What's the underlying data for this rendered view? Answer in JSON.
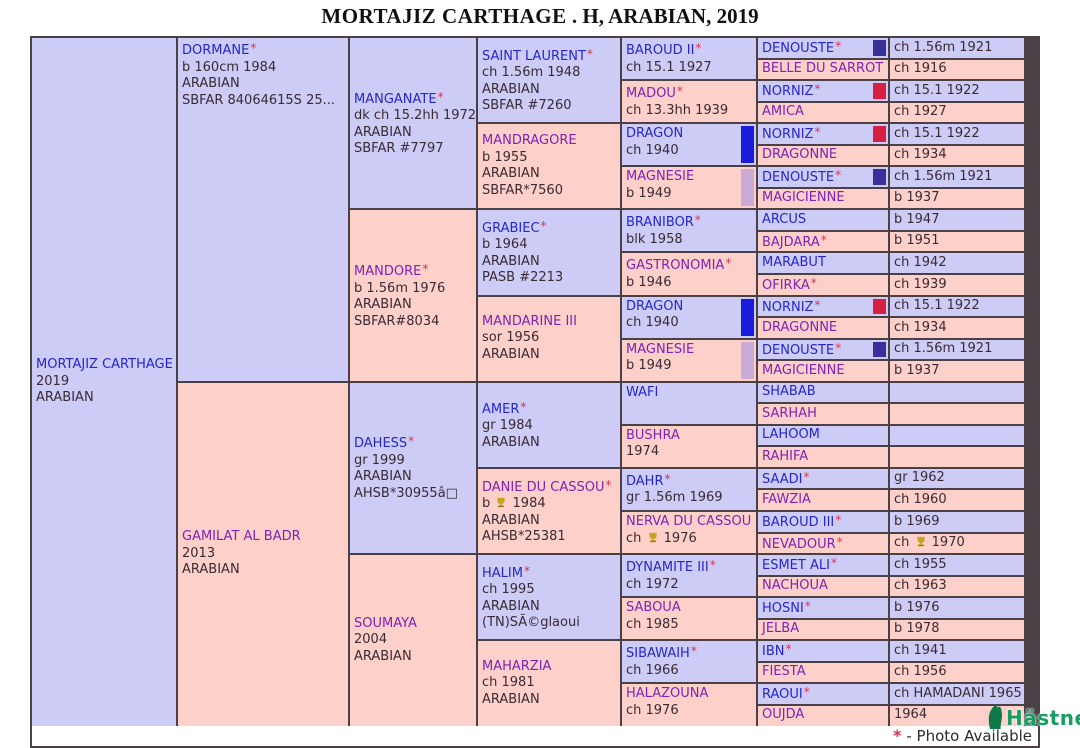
{
  "title": {
    "name": "MORTAJIZ CARTHAGE",
    "rest": " . H, ARABIAN, 2019"
  },
  "footer": {
    "asterisk": "*",
    "note": "- Photo Available"
  },
  "logo": {
    "text": "Hästnet"
  },
  "colors": {
    "male_bg": "#ccccf7",
    "female_bg": "#fdd0ca",
    "male_name": "#2626cc",
    "female_name": "#7d22b5",
    "detail_text": "#3a2a33",
    "asterisk": "#e03050",
    "border": "#4a4046",
    "award_gold": "#c9a227",
    "logo_green": "#189e62",
    "flags": {
      "navy": "#39309c",
      "red": "#d62043",
      "blue": "#1b1bdb",
      "lavender": "#c9abd6"
    }
  },
  "pedigree": {
    "cells": [
      {
        "col": 1,
        "row": 1,
        "span": 32,
        "sex": "m",
        "name": "MORTAJIZ CARTHAGE",
        "ast": false,
        "lines": [
          "2019",
          "ARABIAN"
        ]
      },
      {
        "col": 2,
        "row": 1,
        "span": 16,
        "sex": "m",
        "va": "top",
        "name": "DORMANE",
        "ast": true,
        "lines": [
          "b 160cm 1984",
          "ARABIAN",
          "SBFAR 84064615S 25..."
        ]
      },
      {
        "col": 2,
        "row": 17,
        "span": 16,
        "sex": "f",
        "name": "GAMILAT AL BADR",
        "ast": false,
        "lines": [
          "2013",
          "ARABIAN"
        ]
      },
      {
        "col": 3,
        "row": 1,
        "span": 8,
        "sex": "m",
        "name": "MANGANATE",
        "ast": true,
        "lines": [
          "dk ch 15.2hh 1972",
          "ARABIAN",
          "SBFAR #7797"
        ]
      },
      {
        "col": 3,
        "row": 9,
        "span": 8,
        "sex": "f",
        "name": "MANDORE",
        "ast": true,
        "lines": [
          "b 1.56m 1976",
          "ARABIAN",
          "SBFAR#8034"
        ]
      },
      {
        "col": 3,
        "row": 17,
        "span": 8,
        "sex": "m",
        "name": "DAHESS",
        "ast": true,
        "lines": [
          "gr 1999",
          "ARABIAN",
          "AHSB*30955â□"
        ]
      },
      {
        "col": 3,
        "row": 25,
        "span": 8,
        "sex": "f",
        "name": "SOUMAYA",
        "ast": false,
        "lines": [
          "2004",
          "ARABIAN"
        ]
      },
      {
        "col": 4,
        "row": 1,
        "span": 4,
        "sex": "m",
        "name": "SAINT LAURENT",
        "ast": true,
        "lines": [
          "ch 1.56m 1948",
          "ARABIAN",
          "SBFAR #7260"
        ]
      },
      {
        "col": 4,
        "row": 5,
        "span": 4,
        "sex": "f",
        "name": "MANDRAGORE",
        "ast": false,
        "lines": [
          "b 1955",
          "ARABIAN",
          "SBFAR*7560"
        ]
      },
      {
        "col": 4,
        "row": 9,
        "span": 4,
        "sex": "m",
        "name": "GRABIEC",
        "ast": true,
        "lines": [
          "b 1964",
          "ARABIAN",
          "PASB #2213"
        ]
      },
      {
        "col": 4,
        "row": 13,
        "span": 4,
        "sex": "f",
        "name": "MANDARINE III",
        "ast": false,
        "lines": [
          "sor 1956",
          "ARABIAN"
        ]
      },
      {
        "col": 4,
        "row": 17,
        "span": 4,
        "sex": "m",
        "name": "AMER",
        "ast": true,
        "lines": [
          "gr 1984",
          "ARABIAN"
        ]
      },
      {
        "col": 4,
        "row": 21,
        "span": 4,
        "sex": "f",
        "name": "DANIE DU CASSOU",
        "ast": true,
        "lines": [
          "b [award] 1984",
          "ARABIAN",
          "AHSB*25381"
        ]
      },
      {
        "col": 4,
        "row": 25,
        "span": 4,
        "sex": "m",
        "name": "HALIM",
        "ast": true,
        "lines": [
          "ch 1995",
          "ARABIAN",
          "(TN)SÃ©glaoui"
        ]
      },
      {
        "col": 4,
        "row": 29,
        "span": 4,
        "sex": "f",
        "name": "MAHARZIA",
        "ast": false,
        "lines": [
          "ch 1981",
          "ARABIAN"
        ]
      },
      {
        "col": 5,
        "row": 1,
        "span": 2,
        "sex": "m",
        "name": "BAROUD II",
        "ast": true,
        "lines": [
          "ch 15.1 1927"
        ]
      },
      {
        "col": 5,
        "row": 3,
        "span": 2,
        "sex": "f",
        "name": "MADOU",
        "ast": true,
        "lines": [
          "ch 13.3hh 1939"
        ]
      },
      {
        "col": 5,
        "row": 5,
        "span": 2,
        "sex": "m",
        "name": "DRAGON",
        "ast": false,
        "flag": "blue",
        "lines": [
          "ch 1940"
        ]
      },
      {
        "col": 5,
        "row": 7,
        "span": 2,
        "sex": "f",
        "name": "MAGNESIE",
        "ast": false,
        "flag": "lavender",
        "lines": [
          "b 1949"
        ]
      },
      {
        "col": 5,
        "row": 9,
        "span": 2,
        "sex": "m",
        "name": "BRANIBOR",
        "ast": true,
        "lines": [
          "blk 1958"
        ]
      },
      {
        "col": 5,
        "row": 11,
        "span": 2,
        "sex": "f",
        "name": "GASTRONOMIA",
        "ast": true,
        "lines": [
          "b 1946"
        ]
      },
      {
        "col": 5,
        "row": 13,
        "span": 2,
        "sex": "m",
        "name": "DRAGON",
        "ast": false,
        "flag": "blue",
        "lines": [
          "ch 1940"
        ]
      },
      {
        "col": 5,
        "row": 15,
        "span": 2,
        "sex": "f",
        "name": "MAGNESIE",
        "ast": false,
        "flag": "lavender",
        "lines": [
          "b 1949"
        ]
      },
      {
        "col": 5,
        "row": 17,
        "span": 2,
        "sex": "m",
        "name": "WAFI",
        "ast": false,
        "lines": []
      },
      {
        "col": 5,
        "row": 19,
        "span": 2,
        "sex": "f",
        "name": "BUSHRA",
        "ast": false,
        "lines": [
          "1974"
        ]
      },
      {
        "col": 5,
        "row": 21,
        "span": 2,
        "sex": "m",
        "name": "DAHR",
        "ast": true,
        "lines": [
          "gr 1.56m 1969"
        ]
      },
      {
        "col": 5,
        "row": 23,
        "span": 2,
        "sex": "f",
        "name": "NERVA DU CASSOU",
        "ast": false,
        "lines": [
          "ch [award] 1976"
        ]
      },
      {
        "col": 5,
        "row": 25,
        "span": 2,
        "sex": "m",
        "name": "DYNAMITE III",
        "ast": true,
        "lines": [
          "ch 1972"
        ]
      },
      {
        "col": 5,
        "row": 27,
        "span": 2,
        "sex": "f",
        "name": "SABOUA",
        "ast": false,
        "lines": [
          "ch 1985"
        ]
      },
      {
        "col": 5,
        "row": 29,
        "span": 2,
        "sex": "m",
        "name": "SIBAWAIH",
        "ast": true,
        "lines": [
          "ch 1966"
        ]
      },
      {
        "col": 5,
        "row": 31,
        "span": 2,
        "sex": "f",
        "name": "HALAZOUNA",
        "ast": false,
        "lines": [
          "ch 1976"
        ]
      },
      {
        "col": 6,
        "row": 1,
        "span": 1,
        "sex": "m",
        "name": "DENOUSTE",
        "ast": true,
        "flag": "navy",
        "lines": []
      },
      {
        "col": 6,
        "row": 2,
        "span": 1,
        "sex": "f",
        "name": "BELLE DU SARROT",
        "ast": false,
        "lines": []
      },
      {
        "col": 6,
        "row": 3,
        "span": 1,
        "sex": "m",
        "name": "NORNIZ",
        "ast": true,
        "flag": "red",
        "lines": []
      },
      {
        "col": 6,
        "row": 4,
        "span": 1,
        "sex": "f",
        "name": "AMICA",
        "ast": false,
        "lines": []
      },
      {
        "col": 6,
        "row": 5,
        "span": 1,
        "sex": "m",
        "name": "NORNIZ",
        "ast": true,
        "flag": "red",
        "lines": []
      },
      {
        "col": 6,
        "row": 6,
        "span": 1,
        "sex": "f",
        "name": "DRAGONNE",
        "ast": false,
        "lines": []
      },
      {
        "col": 6,
        "row": 7,
        "span": 1,
        "sex": "m",
        "name": "DENOUSTE",
        "ast": true,
        "flag": "navy",
        "lines": []
      },
      {
        "col": 6,
        "row": 8,
        "span": 1,
        "sex": "f",
        "name": "MAGICIENNE",
        "ast": false,
        "lines": []
      },
      {
        "col": 6,
        "row": 9,
        "span": 1,
        "sex": "m",
        "name": "ARCUS",
        "ast": false,
        "lines": []
      },
      {
        "col": 6,
        "row": 10,
        "span": 1,
        "sex": "f",
        "name": "BAJDARA",
        "ast": true,
        "lines": []
      },
      {
        "col": 6,
        "row": 11,
        "span": 1,
        "sex": "m",
        "name": "MARABUT",
        "ast": false,
        "lines": []
      },
      {
        "col": 6,
        "row": 12,
        "span": 1,
        "sex": "f",
        "name": "OFIRKA",
        "ast": true,
        "lines": []
      },
      {
        "col": 6,
        "row": 13,
        "span": 1,
        "sex": "m",
        "name": "NORNIZ",
        "ast": true,
        "flag": "red",
        "lines": []
      },
      {
        "col": 6,
        "row": 14,
        "span": 1,
        "sex": "f",
        "name": "DRAGONNE",
        "ast": false,
        "lines": []
      },
      {
        "col": 6,
        "row": 15,
        "span": 1,
        "sex": "m",
        "name": "DENOUSTE",
        "ast": true,
        "flag": "navy",
        "lines": []
      },
      {
        "col": 6,
        "row": 16,
        "span": 1,
        "sex": "f",
        "name": "MAGICIENNE",
        "ast": false,
        "lines": []
      },
      {
        "col": 6,
        "row": 17,
        "span": 1,
        "sex": "m",
        "name": "SHABAB",
        "ast": false,
        "lines": []
      },
      {
        "col": 6,
        "row": 18,
        "span": 1,
        "sex": "f",
        "name": "SARHAH",
        "ast": false,
        "lines": []
      },
      {
        "col": 6,
        "row": 19,
        "span": 1,
        "sex": "m",
        "name": "LAHOOM",
        "ast": false,
        "lines": []
      },
      {
        "col": 6,
        "row": 20,
        "span": 1,
        "sex": "f",
        "name": "RAHIFA",
        "ast": false,
        "lines": []
      },
      {
        "col": 6,
        "row": 21,
        "span": 1,
        "sex": "m",
        "name": "SAADI",
        "ast": true,
        "lines": []
      },
      {
        "col": 6,
        "row": 22,
        "span": 1,
        "sex": "f",
        "name": "FAWZIA",
        "ast": false,
        "lines": []
      },
      {
        "col": 6,
        "row": 23,
        "span": 1,
        "sex": "m",
        "name": "BAROUD III",
        "ast": true,
        "lines": []
      },
      {
        "col": 6,
        "row": 24,
        "span": 1,
        "sex": "f",
        "name": "NEVADOUR",
        "ast": true,
        "lines": []
      },
      {
        "col": 6,
        "row": 25,
        "span": 1,
        "sex": "m",
        "name": "ESMET ALI",
        "ast": true,
        "lines": []
      },
      {
        "col": 6,
        "row": 26,
        "span": 1,
        "sex": "f",
        "name": "NACHOUA",
        "ast": false,
        "lines": []
      },
      {
        "col": 6,
        "row": 27,
        "span": 1,
        "sex": "m",
        "name": "HOSNI",
        "ast": true,
        "lines": []
      },
      {
        "col": 6,
        "row": 28,
        "span": 1,
        "sex": "f",
        "name": "JELBA",
        "ast": false,
        "lines": []
      },
      {
        "col": 6,
        "row": 29,
        "span": 1,
        "sex": "m",
        "name": "IBN",
        "ast": true,
        "lines": []
      },
      {
        "col": 6,
        "row": 30,
        "span": 1,
        "sex": "f",
        "name": "FIESTA",
        "ast": false,
        "lines": []
      },
      {
        "col": 6,
        "row": 31,
        "span": 1,
        "sex": "m",
        "name": "RAOUI",
        "ast": true,
        "lines": []
      },
      {
        "col": 6,
        "row": 32,
        "span": 1,
        "sex": "f",
        "name": "OUJDA",
        "ast": false,
        "lines": []
      },
      {
        "col": 7,
        "row": 1,
        "span": 1,
        "sex": "m",
        "lines": [
          "ch 1.56m 1921"
        ]
      },
      {
        "col": 7,
        "row": 2,
        "span": 1,
        "sex": "f",
        "lines": [
          "ch 1916"
        ]
      },
      {
        "col": 7,
        "row": 3,
        "span": 1,
        "sex": "m",
        "lines": [
          "ch 15.1 1922"
        ]
      },
      {
        "col": 7,
        "row": 4,
        "span": 1,
        "sex": "f",
        "lines": [
          "ch 1927"
        ]
      },
      {
        "col": 7,
        "row": 5,
        "span": 1,
        "sex": "m",
        "lines": [
          "ch 15.1 1922"
        ]
      },
      {
        "col": 7,
        "row": 6,
        "span": 1,
        "sex": "f",
        "lines": [
          "ch 1934"
        ]
      },
      {
        "col": 7,
        "row": 7,
        "span": 1,
        "sex": "m",
        "lines": [
          "ch 1.56m 1921"
        ]
      },
      {
        "col": 7,
        "row": 8,
        "span": 1,
        "sex": "f",
        "lines": [
          "b 1937"
        ]
      },
      {
        "col": 7,
        "row": 9,
        "span": 1,
        "sex": "m",
        "lines": [
          "b 1947"
        ]
      },
      {
        "col": 7,
        "row": 10,
        "span": 1,
        "sex": "f",
        "lines": [
          "b 1951"
        ]
      },
      {
        "col": 7,
        "row": 11,
        "span": 1,
        "sex": "m",
        "lines": [
          "ch 1942"
        ]
      },
      {
        "col": 7,
        "row": 12,
        "span": 1,
        "sex": "f",
        "lines": [
          "ch 1939"
        ]
      },
      {
        "col": 7,
        "row": 13,
        "span": 1,
        "sex": "m",
        "lines": [
          "ch 15.1 1922"
        ]
      },
      {
        "col": 7,
        "row": 14,
        "span": 1,
        "sex": "f",
        "lines": [
          "ch 1934"
        ]
      },
      {
        "col": 7,
        "row": 15,
        "span": 1,
        "sex": "m",
        "lines": [
          "ch 1.56m 1921"
        ]
      },
      {
        "col": 7,
        "row": 16,
        "span": 1,
        "sex": "f",
        "lines": [
          "b 1937"
        ]
      },
      {
        "col": 7,
        "row": 17,
        "span": 1,
        "sex": "m",
        "lines": []
      },
      {
        "col": 7,
        "row": 18,
        "span": 1,
        "sex": "f",
        "lines": []
      },
      {
        "col": 7,
        "row": 19,
        "span": 1,
        "sex": "m",
        "lines": []
      },
      {
        "col": 7,
        "row": 20,
        "span": 1,
        "sex": "f",
        "lines": []
      },
      {
        "col": 7,
        "row": 21,
        "span": 1,
        "sex": "m",
        "lines": [
          "gr 1962"
        ]
      },
      {
        "col": 7,
        "row": 22,
        "span": 1,
        "sex": "f",
        "lines": [
          "ch 1960"
        ]
      },
      {
        "col": 7,
        "row": 23,
        "span": 1,
        "sex": "m",
        "lines": [
          "b 1969"
        ]
      },
      {
        "col": 7,
        "row": 24,
        "span": 1,
        "sex": "f",
        "lines": [
          "ch [award] 1970"
        ]
      },
      {
        "col": 7,
        "row": 25,
        "span": 1,
        "sex": "m",
        "lines": [
          "ch 1955"
        ]
      },
      {
        "col": 7,
        "row": 26,
        "span": 1,
        "sex": "f",
        "lines": [
          "ch 1963"
        ]
      },
      {
        "col": 7,
        "row": 27,
        "span": 1,
        "sex": "m",
        "lines": [
          "b 1976"
        ]
      },
      {
        "col": 7,
        "row": 28,
        "span": 1,
        "sex": "f",
        "lines": [
          "b 1978"
        ]
      },
      {
        "col": 7,
        "row": 29,
        "span": 1,
        "sex": "m",
        "lines": [
          "ch 1941"
        ]
      },
      {
        "col": 7,
        "row": 30,
        "span": 1,
        "sex": "f",
        "lines": [
          "ch 1956"
        ]
      },
      {
        "col": 7,
        "row": 31,
        "span": 1,
        "sex": "m",
        "lines": [
          "ch HAMADANI 1965"
        ]
      },
      {
        "col": 7,
        "row": 32,
        "span": 1,
        "sex": "f",
        "lines": [
          "1964"
        ]
      }
    ]
  }
}
